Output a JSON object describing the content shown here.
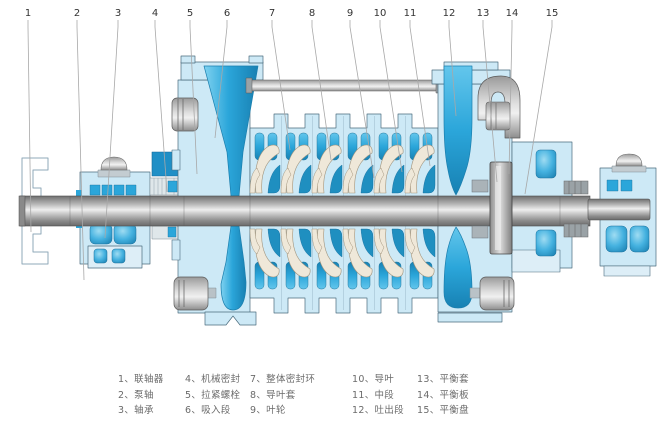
{
  "diagram": {
    "callouts": [
      "1",
      "2",
      "3",
      "4",
      "5",
      "6",
      "7",
      "8",
      "9",
      "10",
      "11",
      "12",
      "13",
      "14",
      "15"
    ]
  },
  "legend": {
    "columns": [
      [
        "1、联轴器",
        "2、泵轴",
        "3、轴承"
      ],
      [
        "4、机械密封",
        "5、拉紧螺栓",
        "6、吸入段"
      ],
      [
        "7、整体密封环",
        "8、导叶套",
        "9、叶轮"
      ],
      [
        "10、导叶",
        "11、中段",
        "12、吐出段"
      ],
      [
        "13、平衡套",
        "14、平衡板",
        "15、平衡盘"
      ]
    ]
  },
  "colors": {
    "casing_light_blue": "#cde9f6",
    "accent_blue": "#2ba6da",
    "shaft_gray": "#b5b5b5",
    "outline": "#4a6b7d",
    "leader_line": "#a8a8a8",
    "legend_text": "#6b6b6b"
  }
}
